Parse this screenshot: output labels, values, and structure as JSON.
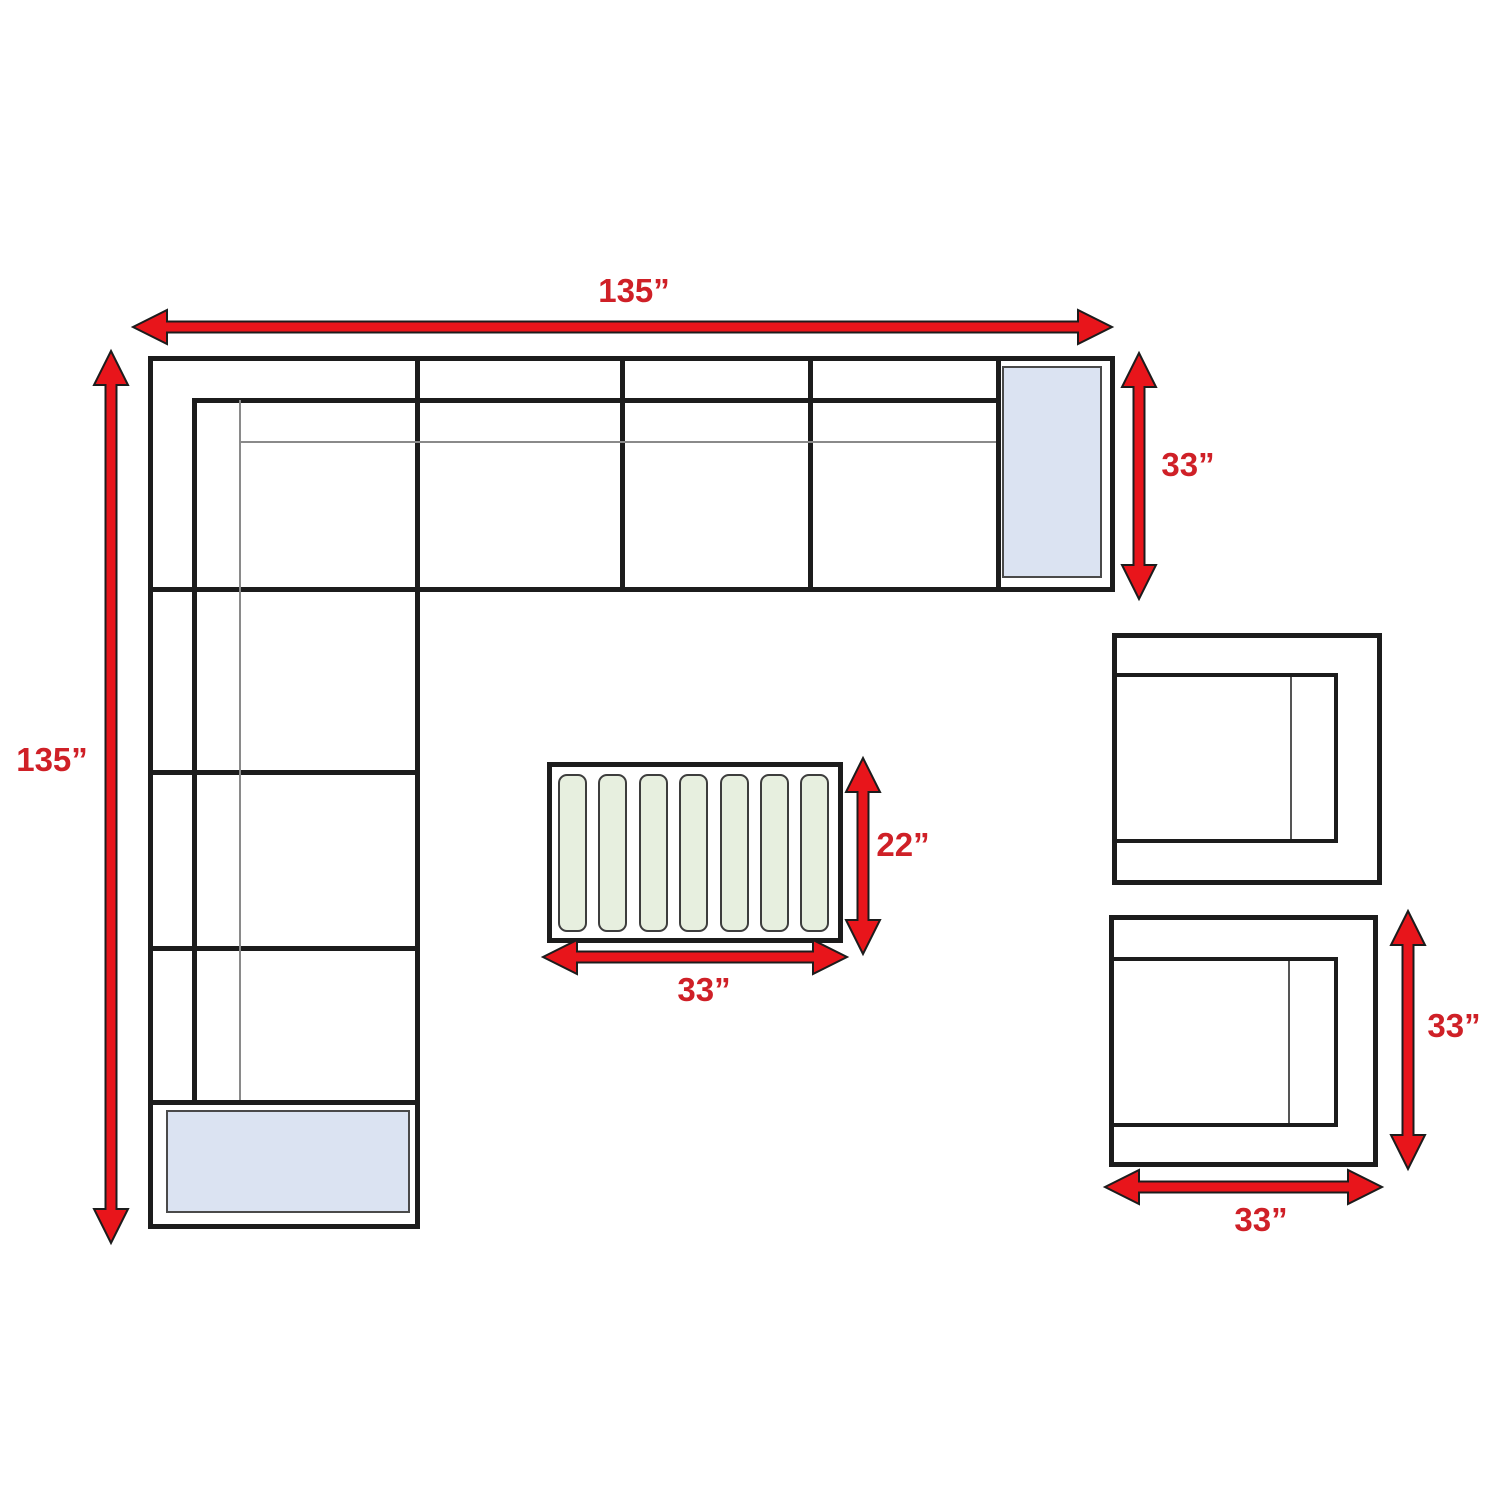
{
  "labels": {
    "sectional_width": "135”",
    "sectional_height": "135”",
    "sectional_depth": "33”",
    "coffee_table_depth": "22”",
    "coffee_table_width": "33”",
    "chair_depth": "33”",
    "chair_width": "33”"
  },
  "coffee_table": {
    "slat_count": 7
  },
  "colors": {
    "arrow_red": "#e8151b",
    "label_red": "#cf2027",
    "line_black": "#1c1c1c",
    "thin_line_gray": "#8a8a8a",
    "end_table_blue": "#dbe3f2",
    "slat_green": "#e7efdf"
  }
}
